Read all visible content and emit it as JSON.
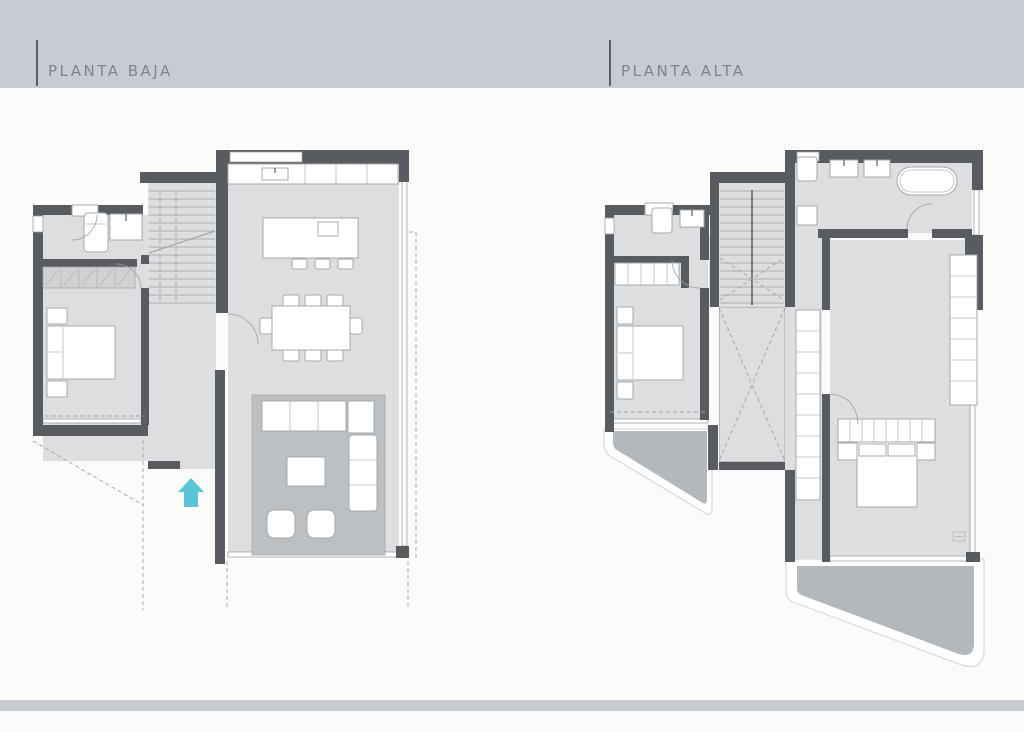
{
  "page": {
    "background": "#fbfbf9"
  },
  "plans": [
    {
      "id": "planta-baja",
      "title": "PLANTA BAJA"
    },
    {
      "id": "planta-alta",
      "title": "PLANTA ALTA"
    }
  ],
  "colors": {
    "page_bg": "#fbfbf9",
    "band": "#c7ccd3",
    "title_text": "#7f848c",
    "title_bar": "#5a6066",
    "wall": "#585c60",
    "floor": "#dcdedf",
    "rug": "#bdc0c3",
    "terrace": "#b5b8bb",
    "terrace_border": "#ffffff",
    "furniture_fill": "#ffffff",
    "furniture_stroke": "#a5a8ab",
    "glass": "#9da0a3",
    "dashed": "#a0a3a7",
    "hatch": "#cfd1d3",
    "entrance_arrow": "#5bc5d8"
  }
}
